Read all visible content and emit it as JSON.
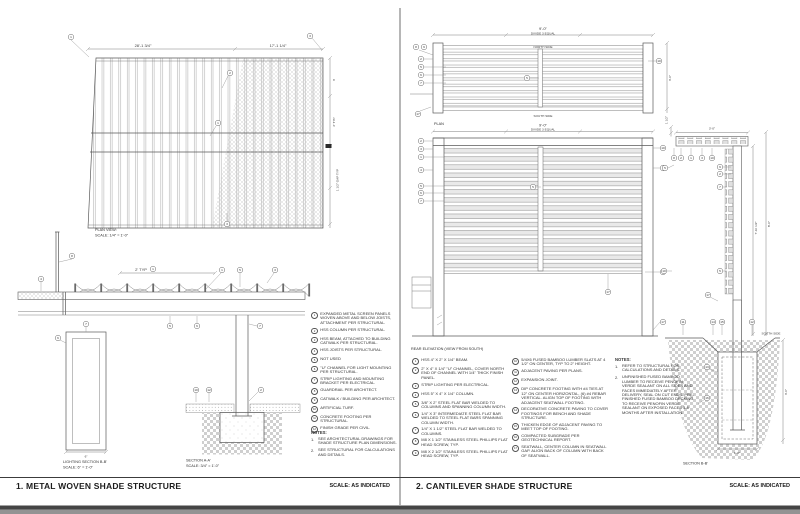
{
  "left": {
    "title": "1. METAL WOVEN SHADE STRUCTURE",
    "scale": "SCALE: AS INDICATED",
    "plan": {
      "label": "PLAN VIEW:",
      "scale": "SCALE: 1/4\" = 1'-0\"",
      "dim1": "28'-1 3/4\"",
      "dim2": "17'-1 1/4\"",
      "dimr1": "3'",
      "dimr2": "2' TYP",
      "dimr3": "1 1/2\" GAP TYP"
    },
    "elev": {
      "dim": "2' TYP"
    },
    "lighting": {
      "label": "LIGHTING SECTION B-B'",
      "scale": "SCALE: 6\" = 1'-0\"",
      "dim": "6\""
    },
    "section": {
      "label": "SECTION A-A'",
      "scale": "SCALE: 3/4\" = 1'-0\""
    },
    "callouts": [
      "1",
      "3",
      "2",
      "1",
      "3",
      "1",
      "8",
      "4",
      "1",
      "5",
      "3",
      "5",
      "6",
      "7",
      "6",
      "7",
      "10",
      "12",
      "2"
    ],
    "keynotes": [
      {
        "n": "1",
        "text": "EXPANDED METAL SCREEN PANELS WOVEN ABOVE AND BELOW JOISTS, ATTACHMENT PER STRUCTURAL."
      },
      {
        "n": "2",
        "text": "HSS COLUMN PER STRUCTURAL."
      },
      {
        "n": "3",
        "text": "HSS BEAM, ATTACHED TO BUILDING CATWALK PER STRUCTURAL."
      },
      {
        "n": "4",
        "text": "HSS JOISTS PER STRUCTURAL."
      },
      {
        "n": "5",
        "text": "NOT USED"
      },
      {
        "n": "6",
        "text": "\"U\" CHANNEL FOR LIGHT MOUNTING PER STRUCTURAL."
      },
      {
        "n": "7",
        "text": "STRIP LIGHTING AND MOUNTING BRACKET PER ELECTRICAL."
      },
      {
        "n": "8",
        "text": "GUARDRAIL PER ARCHITECT."
      },
      {
        "n": "9",
        "text": "CATWALK / BUILDING PER ARCHITECT."
      },
      {
        "n": "10",
        "text": "ARTIFICIAL TURF."
      },
      {
        "n": "11",
        "text": "CONCRETE FOOTING PER STRUCTURAL."
      },
      {
        "n": "12",
        "text": "FINISH GRADE PER CIVIL."
      }
    ],
    "notes_heading": "NOTES:",
    "notes": [
      {
        "n": "1.",
        "text": "SEE ARCHITECTURAL DRAWINGS FOR SHADE STRUCTURE PLAN DIMENSIONS."
      },
      {
        "n": "2.",
        "text": "SEE STRUCTURAL FOR CALCULATIONS AND DETAILS."
      }
    ]
  },
  "right": {
    "title": "2. CANTILEVER SHADE STRUCTURE",
    "scale": "SCALE: AS INDICATED",
    "plan": {
      "label": "PLAN",
      "dim1": "9'-0\"",
      "dim2": "DIVIDE 3 EQUAL",
      "north": "NORTH SIDE",
      "south": "SOUTH SIDE",
      "dimr": "3'-0\""
    },
    "elev": {
      "label": "REAR ELEVATION (VIEW FROM SOUTH)",
      "dim1": "9'-0\"",
      "dim2": "DIVIDE 3 EQUAL"
    },
    "sect": {
      "dim_top": "3'-0\"",
      "dim_small": "1 1/2\"",
      "dim_h1": "7'-10 1/2\"",
      "dim_h2": "8'-0\""
    },
    "foot": {
      "label": "SECTION B-B'",
      "south": "SOUTH SIDE",
      "dim_d": "3'-0\"",
      "dim_w": "1'-6\""
    },
    "callouts": [
      "8",
      "9",
      "2",
      "5",
      "6",
      "7",
      "5",
      "10",
      "17",
      "2",
      "3",
      "1",
      "4",
      "5",
      "6",
      "7",
      "10",
      "5",
      "7",
      "17",
      "5",
      "17",
      "8",
      "2",
      "1",
      "3",
      "10",
      "9",
      "2",
      "7",
      "5",
      "5",
      "10",
      "11",
      "14",
      "15",
      "12",
      "13",
      "16",
      "17"
    ],
    "keynotes_a": [
      {
        "n": "1",
        "text": "HSS 4\" X 2\" X 1/4\" BEAM."
      },
      {
        "n": "2",
        "text": "2\" X 4\" X 1/4\" \"U\" CHANNEL, COVER NORTH END OF CHANNEL WITH 1/4\" THICK FINISH PANEL."
      },
      {
        "n": "3",
        "text": "STRIP LIGHTING PER ELECTRICAL."
      },
      {
        "n": "4",
        "text": "HSS 5\" X 4\" X 1/4\" COLUMN."
      },
      {
        "n": "5",
        "text": "3/8\" X 2\" STEEL FLAT BAR WELDED TO COLUMNS AND SPANNING COLUMN WIDTH."
      },
      {
        "n": "6",
        "text": "1/4\" X 3\" INTERMEDIATE STEEL FLAT BAR WELDED TO STEEL FLAT BARS SPANNING COLUMN WIDTH."
      },
      {
        "n": "7",
        "text": "1/4\" X 1 1/2\" STEEL FLAT BAR WELDED TO COLUMNS."
      },
      {
        "n": "8",
        "text": "M8 X 1 1/2\" STAINLESS STEEL PHILLIPS FLAT HEAD SCREW, TYP."
      },
      {
        "n": "9",
        "text": "M8 X 2 1/2\" STAINLESS STEEL PHILLIPS FLAT HEAD SCREW, TYP."
      }
    ],
    "keynotes_b": [
      {
        "n": "10",
        "text": "5/4X6 FUSED BAMBOO LUMBER SLATS AT 4 1/2\" ON CENTER, TYP TO 2\" HEIGHT."
      },
      {
        "n": "11",
        "text": "ADJACENT PAVING PER PLANS."
      },
      {
        "n": "12",
        "text": "EXPANSION JOINT."
      },
      {
        "n": "13",
        "text": "DIP CONCRETE FOOTING WITH #4 TIES AT 12\" ON CENTER HORIZONTAL, (6) #4 REBAR VERTICAL. ALIGN TOP OF FOOTING WITH ADJACENT SEATWALL FOOTING."
      },
      {
        "n": "14",
        "text": "DECORATIVE CONCRETE PAVING TO COVER FOOTINGS FOR BENCH AND SHADE STRUCTURE."
      },
      {
        "n": "15",
        "text": "THICKEN EDGE OF ADJACENT PAVING TO MEET TOP OF FOOTING."
      },
      {
        "n": "16",
        "text": "COMPACTED SUBGRADE PER GEOTECHNICAL REPORT."
      },
      {
        "n": "17",
        "text": "SEATWALL, CENTER COLUMN IN SEATWALL GAP. ALIGN BACK OF COLUMN WITH BACK OF SEATWALL."
      }
    ],
    "notes_heading": "NOTES:",
    "notes": [
      {
        "n": "1.",
        "text": "REFER TO STRUCTURAL FOR CALCULATIONS AND DETAILS."
      },
      {
        "n": "2.",
        "text": "UNFINISHED FUSED BAMBOO LUMBER TO RECEIVE PENOFIN VERDE SEALANT ON ALL SIDES AND FACES IMMEDIATELY AFTER DELIVERY, SEAL ON CUT ENDS. PRE-FINISHED FUSED BAMBOO DECKING TO RECEIVE PENOFIN VERDE SEALANT ON EXPOSED FACES 3-6 MONTHS AFTER INSTALLATION."
      }
    ]
  }
}
